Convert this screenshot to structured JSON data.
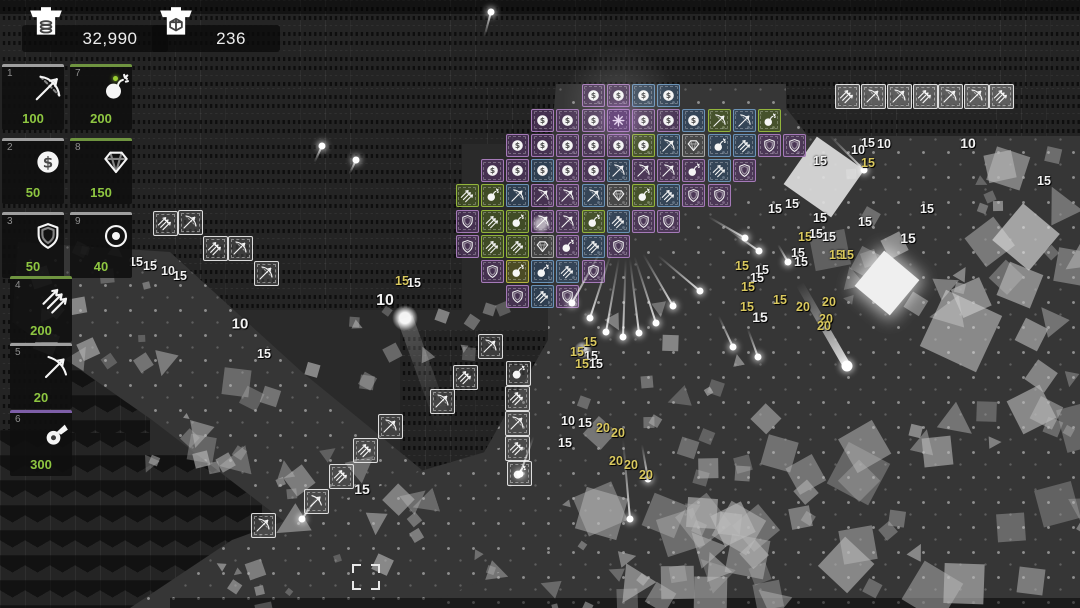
{
  "hud": {
    "gold": "32,990",
    "gems": "236",
    "gold_icon": "chest-coins",
    "gem_icon": "chest-gem"
  },
  "sidebar": {
    "slots": [
      {
        "key": "1",
        "icon": "crossbow",
        "cost": "100",
        "bar": "#9f9f9f",
        "x": 2,
        "y": 64
      },
      {
        "key": "7",
        "icon": "bomb",
        "cost": "200",
        "bar": "#6f9440",
        "x": 70,
        "y": 64,
        "spark": true
      },
      {
        "key": "2",
        "icon": "coin",
        "cost": "50",
        "bar": "#9f9f9f",
        "x": 2,
        "y": 138
      },
      {
        "key": "8",
        "icon": "diamond",
        "cost": "150",
        "bar": "#6f9440",
        "x": 70,
        "y": 138
      },
      {
        "key": "3",
        "icon": "shield",
        "cost": "50",
        "bar": "#9f9f9f",
        "x": 2,
        "y": 212
      },
      {
        "key": "9",
        "icon": "donut",
        "cost": "40",
        "bar": "#9f9f9f",
        "x": 70,
        "y": 212
      },
      {
        "key": "4",
        "icon": "arrows",
        "cost": "200",
        "bar": "#6f9440",
        "x": 10,
        "y": 276
      },
      {
        "key": "5",
        "icon": "bow",
        "cost": "20",
        "bar": "#9f9f9f",
        "x": 10,
        "y": 343
      },
      {
        "key": "6",
        "icon": "cannon",
        "cost": "300",
        "bar": "#7e5fa8",
        "x": 10,
        "y": 410
      }
    ]
  },
  "palette": {
    "P": {
      "border": "#a57ab8",
      "bg": "rgba(98,58,120,0.5)"
    },
    "B": {
      "border": "#6b93b8",
      "bg": "rgba(52,84,120,0.5)"
    },
    "G": {
      "border": "#93b53c",
      "bg": "rgba(92,118,34,0.45)"
    },
    "S": {
      "border": "#a8a8a8",
      "bg": "rgba(90,90,90,0.5)"
    },
    "Y": {
      "border": "#b5b53c",
      "bg": "rgba(118,118,30,0.45)"
    }
  },
  "grid": {
    "origin": {
      "x": 467,
      "y": 95
    },
    "pitch": 25.2,
    "tile_format": "[row, col, icon, color]",
    "tiles": [
      [
        0,
        5,
        "coin",
        "P"
      ],
      [
        0,
        6,
        "coin",
        "P"
      ],
      [
        0,
        7,
        "coin",
        "B"
      ],
      [
        0,
        8,
        "coin",
        "B"
      ],
      [
        1,
        3,
        "coin",
        "P"
      ],
      [
        1,
        4,
        "coin",
        "P"
      ],
      [
        1,
        5,
        "coin",
        "P"
      ],
      [
        1,
        6,
        "sun",
        "P"
      ],
      [
        1,
        7,
        "coin",
        "P"
      ],
      [
        1,
        8,
        "coin",
        "P"
      ],
      [
        1,
        9,
        "coin",
        "B"
      ],
      [
        1,
        10,
        "crossbow",
        "G"
      ],
      [
        1,
        11,
        "crossbow",
        "B"
      ],
      [
        1,
        12,
        "bomb",
        "G"
      ],
      [
        2,
        2,
        "coin",
        "P"
      ],
      [
        2,
        3,
        "coin",
        "P"
      ],
      [
        2,
        4,
        "coin",
        "P"
      ],
      [
        2,
        5,
        "coin",
        "P"
      ],
      [
        2,
        6,
        "coin",
        "P"
      ],
      [
        2,
        7,
        "coin",
        "G"
      ],
      [
        2,
        8,
        "crossbow",
        "B"
      ],
      [
        2,
        9,
        "diamond",
        "S"
      ],
      [
        2,
        10,
        "bomb",
        "B"
      ],
      [
        2,
        11,
        "arrows",
        "B"
      ],
      [
        2,
        12,
        "shield",
        "P"
      ],
      [
        2,
        13,
        "shield",
        "P"
      ],
      [
        3,
        1,
        "coin",
        "P"
      ],
      [
        3,
        2,
        "coin",
        "P"
      ],
      [
        3,
        3,
        "coin",
        "B"
      ],
      [
        3,
        4,
        "coin",
        "P"
      ],
      [
        3,
        5,
        "coin",
        "P"
      ],
      [
        3,
        6,
        "crossbow",
        "B"
      ],
      [
        3,
        7,
        "crossbow",
        "P"
      ],
      [
        3,
        8,
        "crossbow",
        "P"
      ],
      [
        3,
        9,
        "bomb",
        "P"
      ],
      [
        3,
        10,
        "arrows",
        "B"
      ],
      [
        3,
        11,
        "shield",
        "P"
      ],
      [
        4,
        0,
        "arrows",
        "G"
      ],
      [
        4,
        1,
        "bomb",
        "G"
      ],
      [
        4,
        2,
        "crossbow",
        "B"
      ],
      [
        4,
        3,
        "crossbow",
        "P"
      ],
      [
        4,
        4,
        "crossbow",
        "P"
      ],
      [
        4,
        5,
        "crossbow",
        "B"
      ],
      [
        4,
        6,
        "diamond",
        "S"
      ],
      [
        4,
        7,
        "bomb",
        "G"
      ],
      [
        4,
        8,
        "arrows",
        "B"
      ],
      [
        4,
        9,
        "shield",
        "P"
      ],
      [
        4,
        10,
        "shield",
        "P"
      ],
      [
        5,
        0,
        "shield",
        "P"
      ],
      [
        5,
        1,
        "arrows",
        "G"
      ],
      [
        5,
        2,
        "bomb",
        "G"
      ],
      [
        5,
        3,
        "crossbow",
        "P"
      ],
      [
        5,
        4,
        "crossbow",
        "P"
      ],
      [
        5,
        5,
        "bomb",
        "G"
      ],
      [
        5,
        6,
        "arrows",
        "B"
      ],
      [
        5,
        7,
        "shield",
        "P"
      ],
      [
        5,
        8,
        "shield",
        "P"
      ],
      [
        6,
        0,
        "shield",
        "P"
      ],
      [
        6,
        1,
        "arrows",
        "G"
      ],
      [
        6,
        2,
        "arrows",
        "G"
      ],
      [
        6,
        3,
        "diamond",
        "S"
      ],
      [
        6,
        4,
        "bomb",
        "P"
      ],
      [
        6,
        5,
        "arrows",
        "B"
      ],
      [
        6,
        6,
        "shield",
        "P"
      ],
      [
        7,
        1,
        "shield",
        "P"
      ],
      [
        7,
        2,
        "bomb",
        "Y"
      ],
      [
        7,
        3,
        "bomb",
        "B"
      ],
      [
        7,
        4,
        "arrows",
        "B"
      ],
      [
        7,
        5,
        "shield",
        "P"
      ],
      [
        8,
        2,
        "shield",
        "P"
      ],
      [
        8,
        3,
        "arrows",
        "B"
      ],
      [
        8,
        4,
        "shield",
        "P"
      ]
    ]
  },
  "ghost_towers": {
    "format": "[center_x, center_y, icon]",
    "tiles": [
      [
        165,
        223,
        "arrows"
      ],
      [
        190,
        222,
        "crossbow"
      ],
      [
        215,
        248,
        "arrows"
      ],
      [
        240,
        248,
        "crossbow"
      ],
      [
        266,
        273,
        "crossbow"
      ],
      [
        490,
        346,
        "crossbow"
      ],
      [
        465,
        377,
        "arrows"
      ],
      [
        518,
        373,
        "bomb"
      ],
      [
        442,
        401,
        "crossbow"
      ],
      [
        517,
        398,
        "arrows"
      ],
      [
        390,
        426,
        "crossbow"
      ],
      [
        517,
        423,
        "crossbow"
      ],
      [
        365,
        450,
        "arrows"
      ],
      [
        517,
        448,
        "arrows"
      ],
      [
        341,
        476,
        "arrows"
      ],
      [
        519,
        473,
        "bomb"
      ],
      [
        316,
        501,
        "bow"
      ],
      [
        263,
        525,
        "crossbow"
      ]
    ]
  },
  "queued_towers": {
    "y": 96,
    "format": "[center_x, icon]",
    "tiles": [
      [
        847,
        "arrows"
      ],
      [
        873,
        "crossbow"
      ],
      [
        899,
        "crossbow"
      ],
      [
        925,
        "arrows"
      ],
      [
        950,
        "crossbow"
      ],
      [
        976,
        "crossbow"
      ],
      [
        1001,
        "arrows"
      ]
    ]
  },
  "damage_numbers": {
    "format": "[x, y, value, color(w|y), size?]",
    "items": [
      [
        136,
        262,
        "15",
        "w"
      ],
      [
        150,
        266,
        "15",
        "w"
      ],
      [
        168,
        271,
        "10",
        "w"
      ],
      [
        180,
        276,
        "15",
        "w"
      ],
      [
        240,
        324,
        "10",
        "w",
        15
      ],
      [
        264,
        354,
        "15",
        "w"
      ],
      [
        385,
        301,
        "10",
        "w",
        16
      ],
      [
        402,
        281,
        "15",
        "y"
      ],
      [
        414,
        283,
        "15",
        "w"
      ],
      [
        362,
        489,
        "15",
        "w",
        14
      ],
      [
        568,
        421,
        "10",
        "w"
      ],
      [
        585,
        423,
        "15",
        "w"
      ],
      [
        565,
        443,
        "15",
        "w"
      ],
      [
        603,
        428,
        "20",
        "y"
      ],
      [
        618,
        433,
        "20",
        "y"
      ],
      [
        616,
        461,
        "20",
        "y"
      ],
      [
        631,
        465,
        "20",
        "y"
      ],
      [
        646,
        475,
        "20",
        "y"
      ],
      [
        590,
        342,
        "15",
        "y"
      ],
      [
        577,
        352,
        "15",
        "y"
      ],
      [
        591,
        356,
        "15",
        "w"
      ],
      [
        582,
        364,
        "15",
        "y"
      ],
      [
        596,
        364,
        "15",
        "w"
      ],
      [
        742,
        266,
        "15",
        "y"
      ],
      [
        762,
        270,
        "15",
        "w"
      ],
      [
        757,
        278,
        "15",
        "w"
      ],
      [
        748,
        287,
        "15",
        "y"
      ],
      [
        747,
        307,
        "15",
        "y"
      ],
      [
        760,
        317,
        "15",
        "w",
        14
      ],
      [
        775,
        209,
        "15",
        "w"
      ],
      [
        792,
        204,
        "15",
        "w"
      ],
      [
        820,
        218,
        "15",
        "w"
      ],
      [
        865,
        222,
        "15",
        "w"
      ],
      [
        927,
        209,
        "15",
        "w"
      ],
      [
        805,
        237,
        "15",
        "y"
      ],
      [
        816,
        234,
        "15",
        "w"
      ],
      [
        829,
        237,
        "15",
        "w"
      ],
      [
        908,
        238,
        "15",
        "w",
        14
      ],
      [
        798,
        253,
        "15",
        "w"
      ],
      [
        801,
        262,
        "15",
        "w"
      ],
      [
        836,
        255,
        "15",
        "y"
      ],
      [
        847,
        255,
        "15",
        "y"
      ],
      [
        780,
        300,
        "15",
        "y"
      ],
      [
        803,
        307,
        "20",
        "y"
      ],
      [
        829,
        302,
        "20",
        "y"
      ],
      [
        826,
        319,
        "20",
        "y"
      ],
      [
        824,
        326,
        "20",
        "y"
      ],
      [
        820,
        161,
        "15",
        "w"
      ],
      [
        868,
        163,
        "15",
        "y"
      ],
      [
        868,
        143,
        "15",
        "w"
      ],
      [
        858,
        150,
        "10",
        "w"
      ],
      [
        884,
        144,
        "10",
        "w"
      ],
      [
        968,
        143,
        "10",
        "w",
        14
      ],
      [
        1044,
        181,
        "15",
        "w"
      ]
    ]
  },
  "projectiles": {
    "format": "[dot_x, dot_y, trail_angle_deg, trail_len, thickness?]",
    "items": [
      [
        491,
        12,
        105,
        26
      ],
      [
        322,
        146,
        115,
        18
      ],
      [
        356,
        160,
        115,
        16
      ],
      [
        572,
        303,
        -61,
        60
      ],
      [
        590,
        318,
        -72,
        70
      ],
      [
        606,
        332,
        -80,
        75
      ],
      [
        623,
        337,
        -88,
        78
      ],
      [
        639,
        333,
        -97,
        75
      ],
      [
        656,
        323,
        -108,
        70
      ],
      [
        673,
        306,
        -120,
        60
      ],
      [
        700,
        291,
        -140,
        55
      ],
      [
        745,
        238,
        -150,
        42
      ],
      [
        759,
        251,
        -145,
        38
      ],
      [
        630,
        519,
        -95,
        80
      ],
      [
        520,
        474,
        -70,
        40
      ],
      [
        648,
        479,
        -100,
        35
      ],
      [
        302,
        519,
        -55,
        26
      ],
      [
        864,
        170,
        -135,
        48
      ],
      [
        788,
        262,
        -120,
        20
      ],
      [
        733,
        347,
        -115,
        34
      ],
      [
        758,
        357,
        -110,
        30
      ],
      [
        847,
        366,
        -120,
        95,
        8
      ]
    ]
  },
  "effects": [
    {
      "type": "glow",
      "x": 620,
      "y": 103,
      "r": 58,
      "o": 0.1,
      "color": "255,255,255"
    },
    {
      "type": "glow",
      "x": 620,
      "y": 120,
      "r": 24,
      "o": 0.28,
      "color": "192,128,224"
    },
    {
      "type": "glow",
      "x": 541,
      "y": 224,
      "r": 10,
      "o": 0.6,
      "color": "255,255,255"
    },
    {
      "type": "glow",
      "x": 405,
      "y": 318,
      "r": 13,
      "o": 0.95,
      "color": "255,255,255"
    },
    {
      "type": "beam",
      "x": 405,
      "y": 318,
      "a": 70,
      "l": 118,
      "w": 16,
      "o": 0.22
    },
    {
      "type": "glow",
      "x": 583,
      "y": 350,
      "r": 9,
      "o": 0.8,
      "color": "255,255,255"
    },
    {
      "type": "flash",
      "x": 887,
      "y": 283,
      "s": 46,
      "rot": 40
    }
  ],
  "enemy_field": {
    "cluster_format": "[x, y, w, h, count, min_size, max_size, triangle_fraction]",
    "clusters": [
      [
        20,
        240,
        150,
        120,
        16,
        6,
        26,
        0.2
      ],
      [
        140,
        350,
        140,
        120,
        14,
        6,
        30,
        0.25
      ],
      [
        250,
        430,
        170,
        130,
        14,
        6,
        32,
        0.45
      ],
      [
        200,
        555,
        200,
        50,
        8,
        6,
        18,
        0.5
      ],
      [
        430,
        300,
        120,
        110,
        6,
        4,
        14,
        0.3
      ],
      [
        560,
        420,
        250,
        185,
        26,
        8,
        46,
        0.25
      ],
      [
        780,
        400,
        300,
        205,
        26,
        8,
        48,
        0.2
      ],
      [
        800,
        140,
        280,
        160,
        22,
        6,
        36,
        0.3
      ],
      [
        560,
        300,
        230,
        120,
        12,
        6,
        24,
        0.3
      ],
      [
        955,
        270,
        125,
        150,
        8,
        10,
        44,
        0.2
      ],
      [
        290,
        300,
        130,
        85,
        8,
        4,
        18,
        0.2
      ],
      [
        835,
        235,
        130,
        90,
        6,
        8,
        30,
        0.2
      ],
      [
        600,
        480,
        200,
        128,
        12,
        8,
        40,
        0.35
      ],
      [
        450,
        540,
        160,
        68,
        8,
        6,
        22,
        0.5
      ]
    ],
    "notable_format": "[x, y, size, rotation, opacity]",
    "notables": [
      [
        795,
        148,
        58,
        35,
        0.95
      ],
      [
        1002,
        213,
        48,
        40,
        0.8
      ],
      [
        930,
        300,
        62,
        25,
        0.7
      ]
    ]
  },
  "selection": {
    "x": 352,
    "y": 564,
    "w": 28,
    "h": 26
  }
}
